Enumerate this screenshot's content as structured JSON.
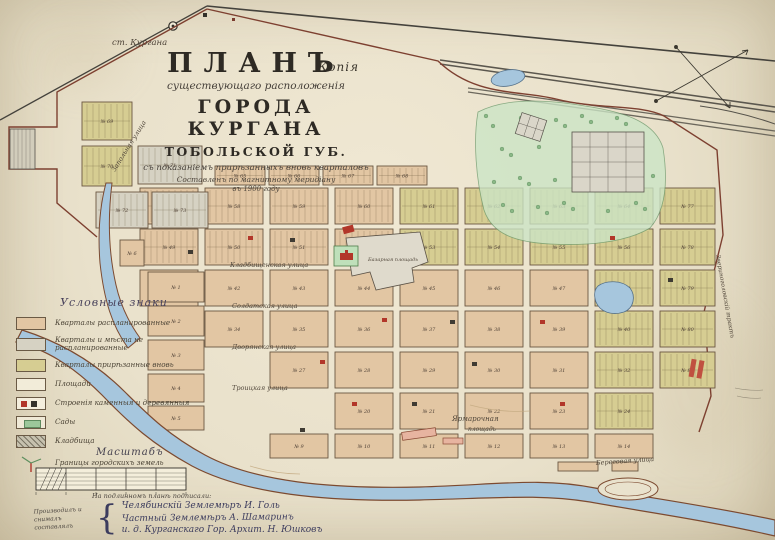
{
  "title": {
    "copy_note": "Копія",
    "plan": "ПЛАНЪ",
    "subtitle1": "существующаго расположенія",
    "city": "ГОРОДА КУРГАНА",
    "province": "ТОБОЛЬСКОЙ ГУБ.",
    "subtitle2": "съ показаніемъ прирѣзанныхъ вновь кварталовъ",
    "subtitle3": "Составленъ по магнитному меридіану",
    "subtitle4": "въ 1900 году"
  },
  "legend": {
    "heading": "Условные знаки",
    "items": [
      {
        "id": "planned",
        "label": "Кварталы распланированные",
        "color": "#e2c6a3"
      },
      {
        "id": "unplanned",
        "label": "Кварталы и мѣста не распланированные",
        "color": "#d6d2c3"
      },
      {
        "id": "new",
        "label": "Кварталы прирѣзанные вновь",
        "color": "#d6cd92"
      },
      {
        "id": "squares",
        "label": "Площади",
        "color": "#f2ecd9"
      },
      {
        "id": "buildings",
        "label": "Строенія каменныя и деревянныя",
        "color": "#b23629"
      },
      {
        "id": "gardens",
        "label": "Сады",
        "color": "#9cc79a"
      },
      {
        "id": "cemeteries",
        "label": "Кладбища",
        "color": "#c6c1ae"
      },
      {
        "id": "boundaries",
        "label": "Границы городскихъ земель",
        "color": "#b0392c"
      }
    ]
  },
  "scale": {
    "heading": "Масштабъ",
    "caption": "На подлинномъ планѣ подписали:",
    "side_note": "Производилъ и снималъ составлялъ",
    "signatures": [
      "Челябинскій Землемѣръ И. Голь",
      "Частный Землемѣръ А. Шамаринъ",
      "и. д. Курганскаго Гор. Архит. Н. Юшковъ"
    ]
  },
  "map": {
    "station_label": "ст. Кургана",
    "block_prefix": "№",
    "squares": {
      "market": "Базарная площадь",
      "fair_line1": "Ярмарочная",
      "fair_line2": "площадь"
    },
    "streets": [
      "Запольная улица",
      "Кладбищенская улица",
      "Солдатская улица",
      "Дворянская улица",
      "Троицкая улица",
      "Береговая улица",
      "Звериноголовскій трактъ"
    ],
    "main_rows": [
      [
        "57",
        "58",
        "59",
        "60",
        "61",
        "62",
        "63",
        "64",
        "77"
      ],
      [
        "49",
        "50",
        "51",
        "52",
        "53",
        "54",
        "55",
        "56",
        "78"
      ],
      [
        "41",
        "42",
        "43",
        "44",
        "45",
        "46",
        "47",
        "48",
        "79"
      ],
      [
        "33",
        "34",
        "35",
        "36",
        "37",
        "38",
        "39",
        "40",
        "80"
      ],
      [
        "25",
        "26",
        "27",
        "28",
        "29",
        "30",
        "31",
        "32",
        "81"
      ],
      [
        "17",
        "18",
        "19",
        "20",
        "21",
        "22",
        "23",
        "24",
        ""
      ]
    ],
    "top_row": [
      "65",
      "66",
      "67",
      "68"
    ],
    "nw_blocks": [
      "69",
      "70",
      "71",
      "72",
      "73"
    ],
    "old_town": [
      "1",
      "2",
      "3",
      "4",
      "5",
      "6"
    ],
    "south_row": [
      "9",
      "10",
      "11",
      "12",
      "13",
      "14"
    ]
  }
}
